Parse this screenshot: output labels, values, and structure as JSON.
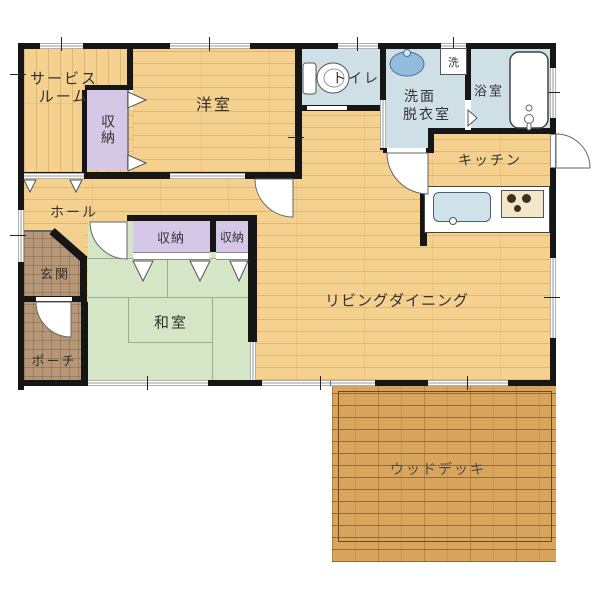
{
  "plan_title": "1LDK+S floor plan",
  "rooms": {
    "service_room": {
      "line1": "サービス",
      "line2": "ルーム"
    },
    "closet_service": {
      "name": "収納"
    },
    "western_room": {
      "name": "洋室"
    },
    "toilet": {
      "name": "トイレ"
    },
    "washroom": {
      "line1": "洗面",
      "line2": "脱衣室"
    },
    "washer_pan": {
      "name": "洗"
    },
    "bathroom": {
      "name": "浴室"
    },
    "kitchen": {
      "name": "キッチン"
    },
    "hall": {
      "name": "ホール"
    },
    "entrance": {
      "name": "玄関"
    },
    "porch": {
      "name": "ポーチ"
    },
    "closet_1": {
      "name": "収納"
    },
    "closet_2": {
      "name": "収納"
    },
    "japanese_room": {
      "name": "和室"
    },
    "living_dining": {
      "name": "リビングダイニング"
    },
    "wood_deck": {
      "name": "ウッドデッキ"
    }
  },
  "icons": [
    "toilet-icon",
    "washbasin-icon",
    "bathtub-icon",
    "washer-pan-icon",
    "kitchen-sink-icon",
    "stove-icon",
    "door-swing-arc",
    "closet-door-triangle",
    "window-symbol"
  ],
  "colors": {
    "wall": "#161616",
    "wood_floor": "#f4d18e",
    "tatami": "#d4e6c6",
    "wet_room": "#cfdfe6",
    "closet": "#d5c8e6",
    "entrance_tile": "#b69879",
    "deck": "#d9a55c",
    "text": "#333333"
  }
}
